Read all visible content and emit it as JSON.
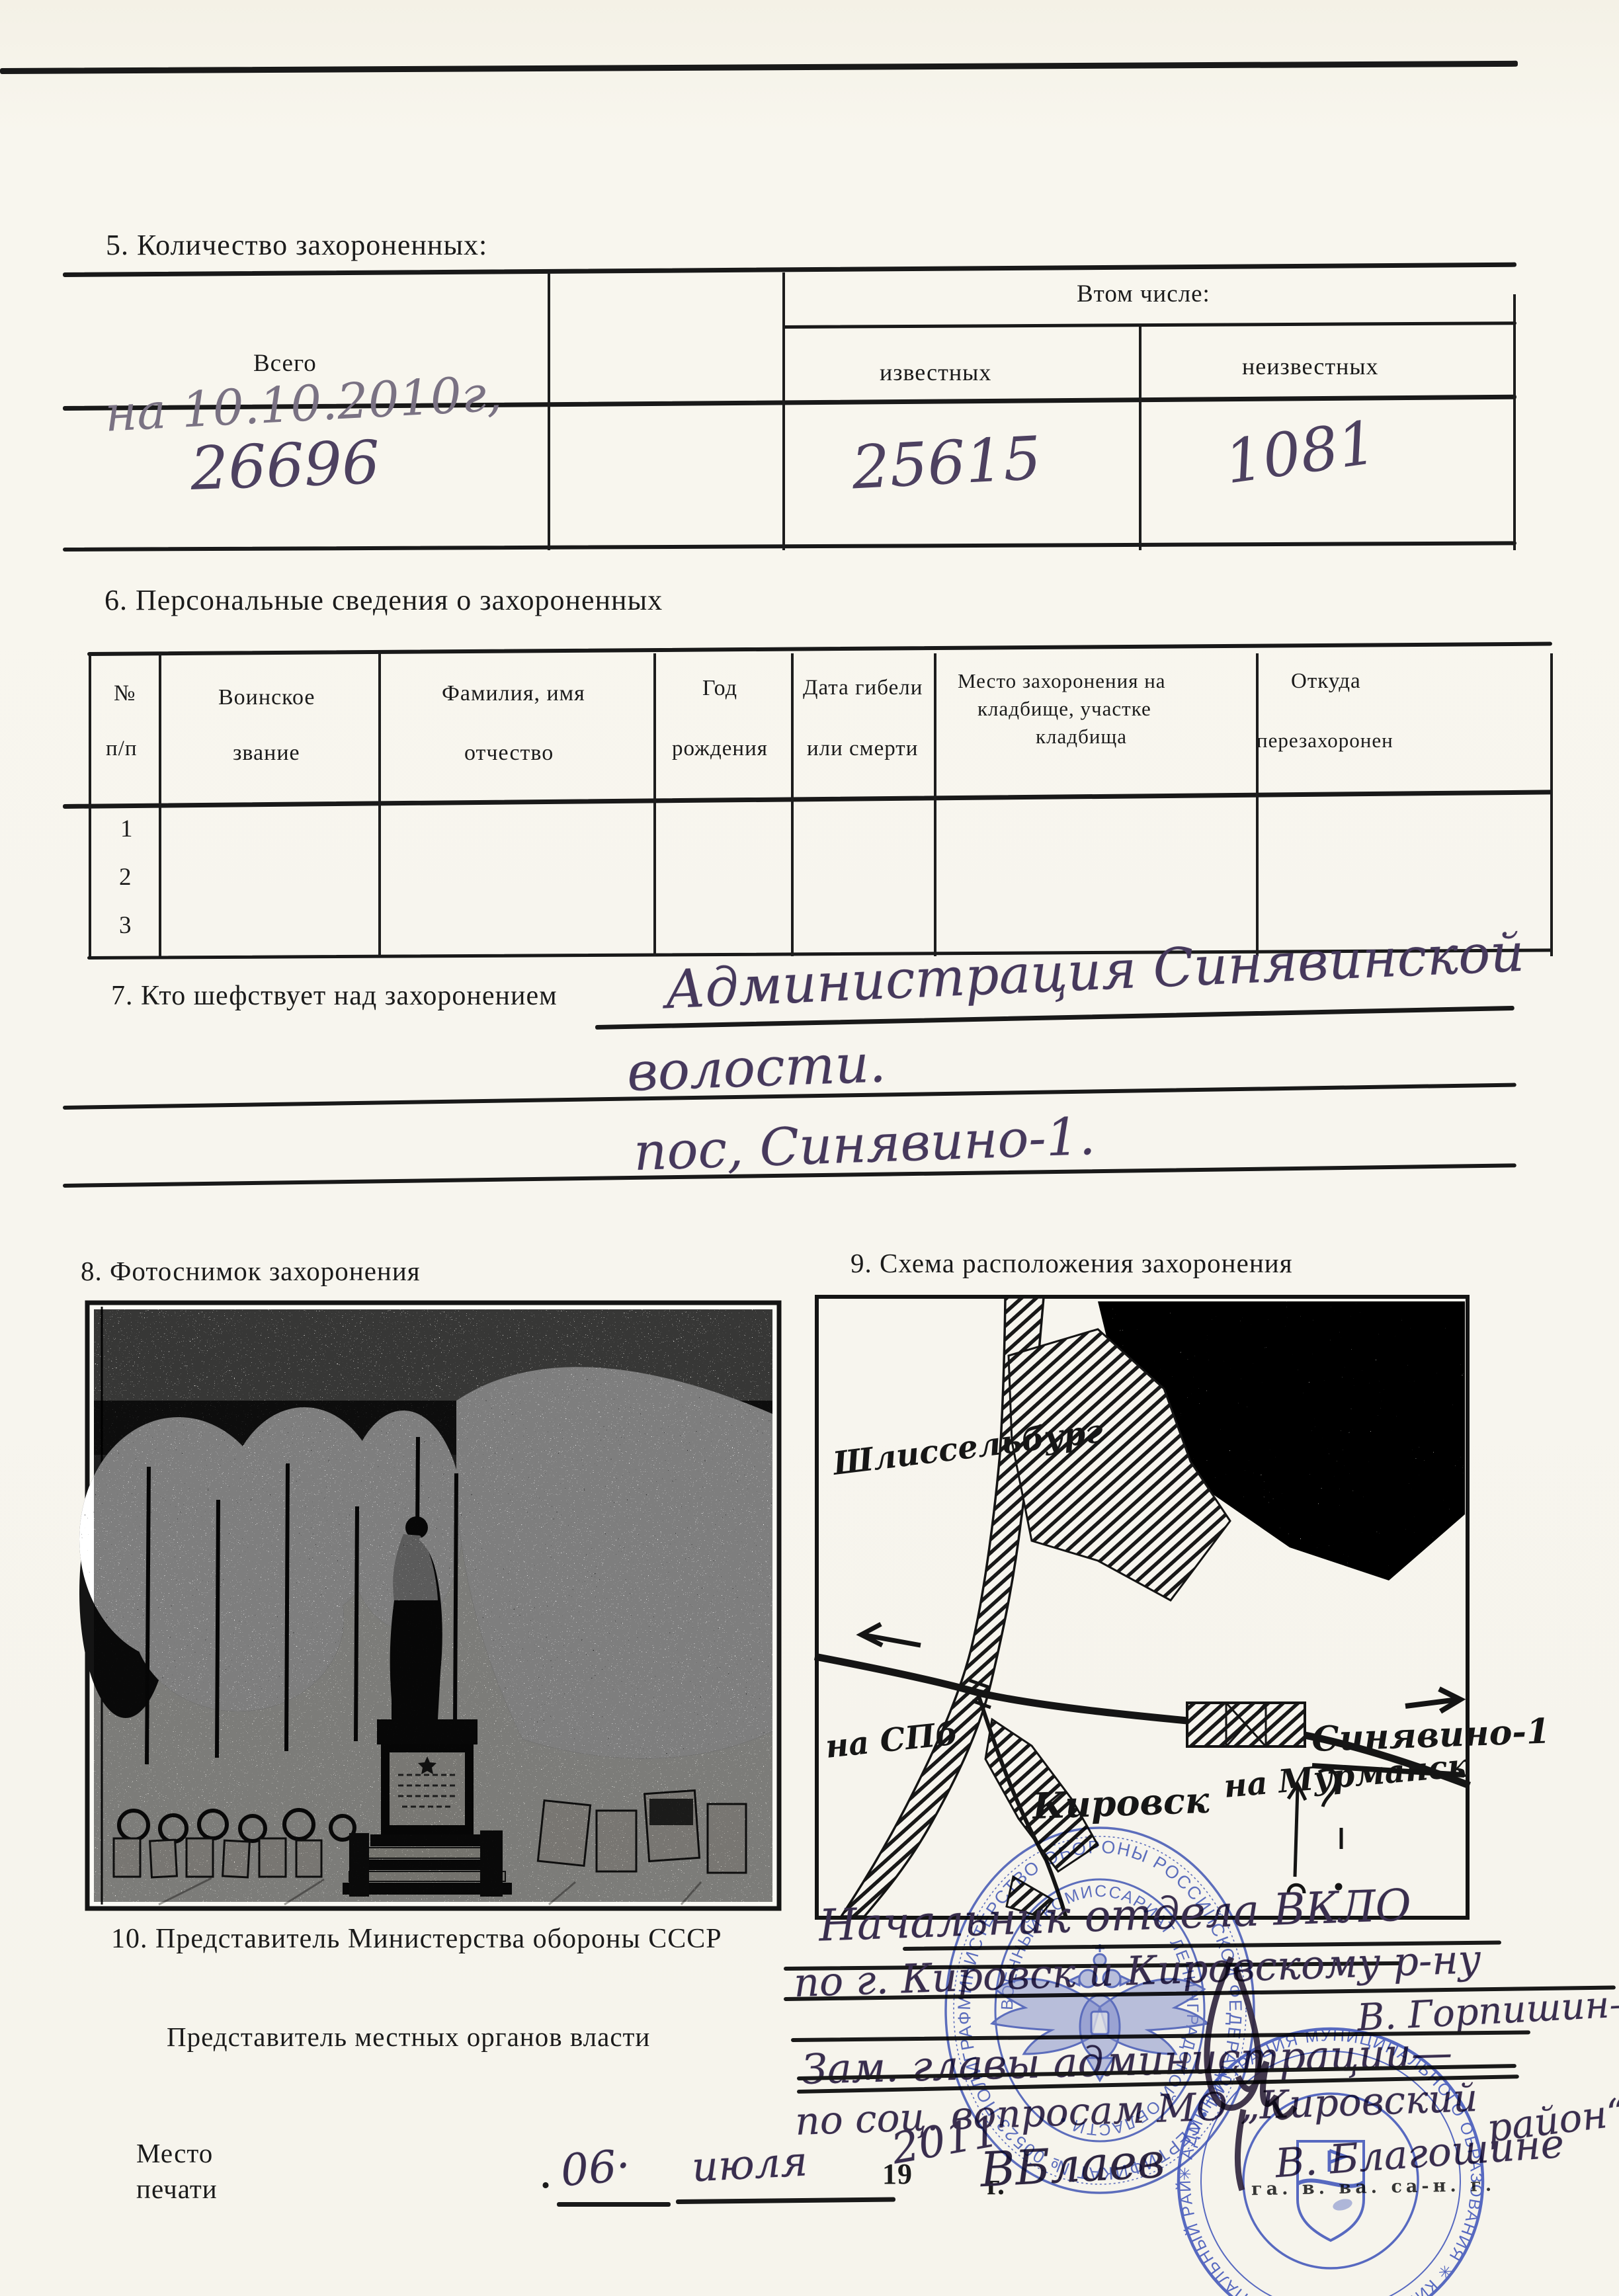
{
  "s5": {
    "title": "5. Количество захороненных:",
    "header_total": "Всего",
    "header_group": "Втом числе:",
    "header_known": "известных",
    "header_unknown": "неизвестных",
    "hw_note": "на 10.10.2010г,",
    "value_total": "26696",
    "value_known": "25615",
    "value_unknown": "1081"
  },
  "s6": {
    "title": "6. Персональные сведения о захороненных",
    "col1a": "№",
    "col1b": "п/п",
    "col2a": "Воинское",
    "col2b": "звание",
    "col3a": "Фамилия, имя",
    "col3b": "отчество",
    "col4a": "Год",
    "col4b": "рождения",
    "col5a": "Дата гибели",
    "col5b": "или смерти",
    "col6a": "Место захоронения на",
    "col6b": "кладбище, участке",
    "col6c": "кладбища",
    "col7a": "Откуда",
    "col7b": "перезахоронен",
    "row1": "1",
    "row2": "2",
    "row3": "3"
  },
  "s7": {
    "label": "7. Кто шефствует над захоронением",
    "hw_line1": "Администрация Синявинской",
    "hw_line2": "волости.",
    "hw_line3": "пос, Синявино-1."
  },
  "s8_label": "8. Фотоснимок захоронения",
  "s9_label": "9. Схема расположения захоронения",
  "map": {
    "town_upper": "Шлиссельбург",
    "road_left": "на СПб",
    "settlement": "Синявино-1",
    "town_lower": "Кировск",
    "road_right": "на Мурманск"
  },
  "s10": {
    "label_mod": "10. Представитель Министерства обороны СССР",
    "hw_position1": "Начальник отдела ВКЛО",
    "hw_position2": "по г. Кировск и Кировскому р-ну",
    "hw_name1": "В. Горпишин—",
    "label_local": "Представитель местных органов власти",
    "hw_position3": "Зам. главы администрации—",
    "hw_position4": "по соц. вопросам МО „Кировский",
    "hw_position4b": "район“",
    "hw_sign_left": "ВБлаев",
    "hw_name2": "В. Благошине",
    "black_mark": "га. в. ва. са-н. г."
  },
  "seal": {
    "label_line1": "Место",
    "label_line2": "печати",
    "dot_left": ".",
    "day": "06·",
    "month": "июля",
    "year_printed": "19",
    "year_hw": "2011",
    "year_suffix": "г."
  },
  "stamps": {
    "military_outer": "МИНИСТЕРСТВО ОБОРОНЫ РОССИЙСКОЙ ФЕДЕРАЦИИ • СЕРТИФИКАТ № 00523-ПОЛИГРАФ •",
    "military_inner": "ВОЕННЫЙ КОМИССАРИАТ ЛЕНИНГРАДСКОЙ ОБЛАСТИ •",
    "admin_outer": "✳ АДМИНИСТРАЦИЯ МУНИЦИПАЛЬНОГО ОБРАЗОВАНИЯ ✳ КИРОВСКИЙ МУНИЦИПАЛЬНЫЙ РАЙОН ЛЕНИНГРАДСКОЙ ОБЛАСТИ"
  }
}
